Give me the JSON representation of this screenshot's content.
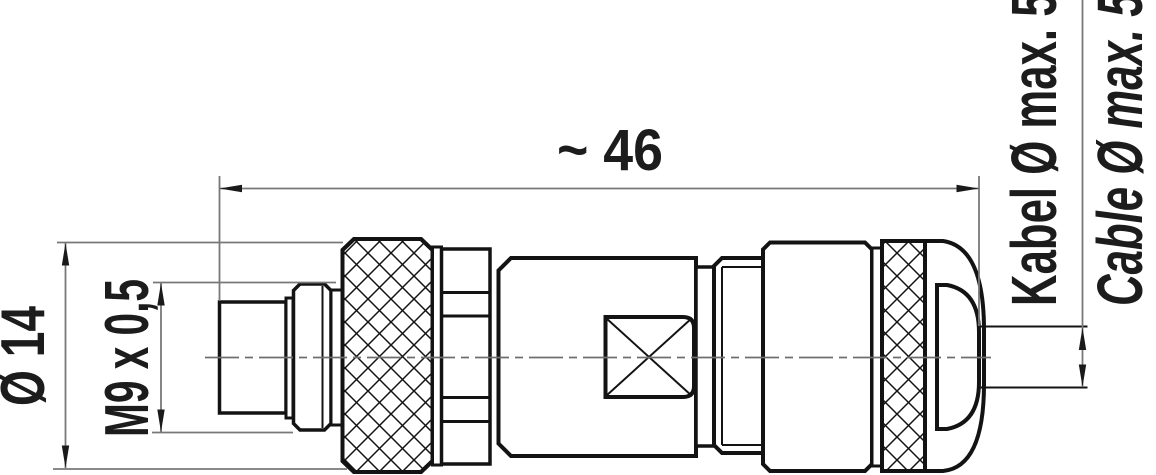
{
  "drawing": {
    "type": "technical-dimension-drawing",
    "part": "circular cable connector, side view",
    "dimensions": {
      "overall_length": "~ 46",
      "outer_diameter": "Ø 14",
      "thread": "M9 x 0,5",
      "cable_label_de": "Kabel Ø max. 5,5",
      "cable_label_en": "Cable Ø max. 5,5"
    },
    "colors": {
      "outline": "#131313",
      "dimension": "#787878",
      "arrow": "#1a1a1a",
      "background": "#ffffff"
    }
  }
}
